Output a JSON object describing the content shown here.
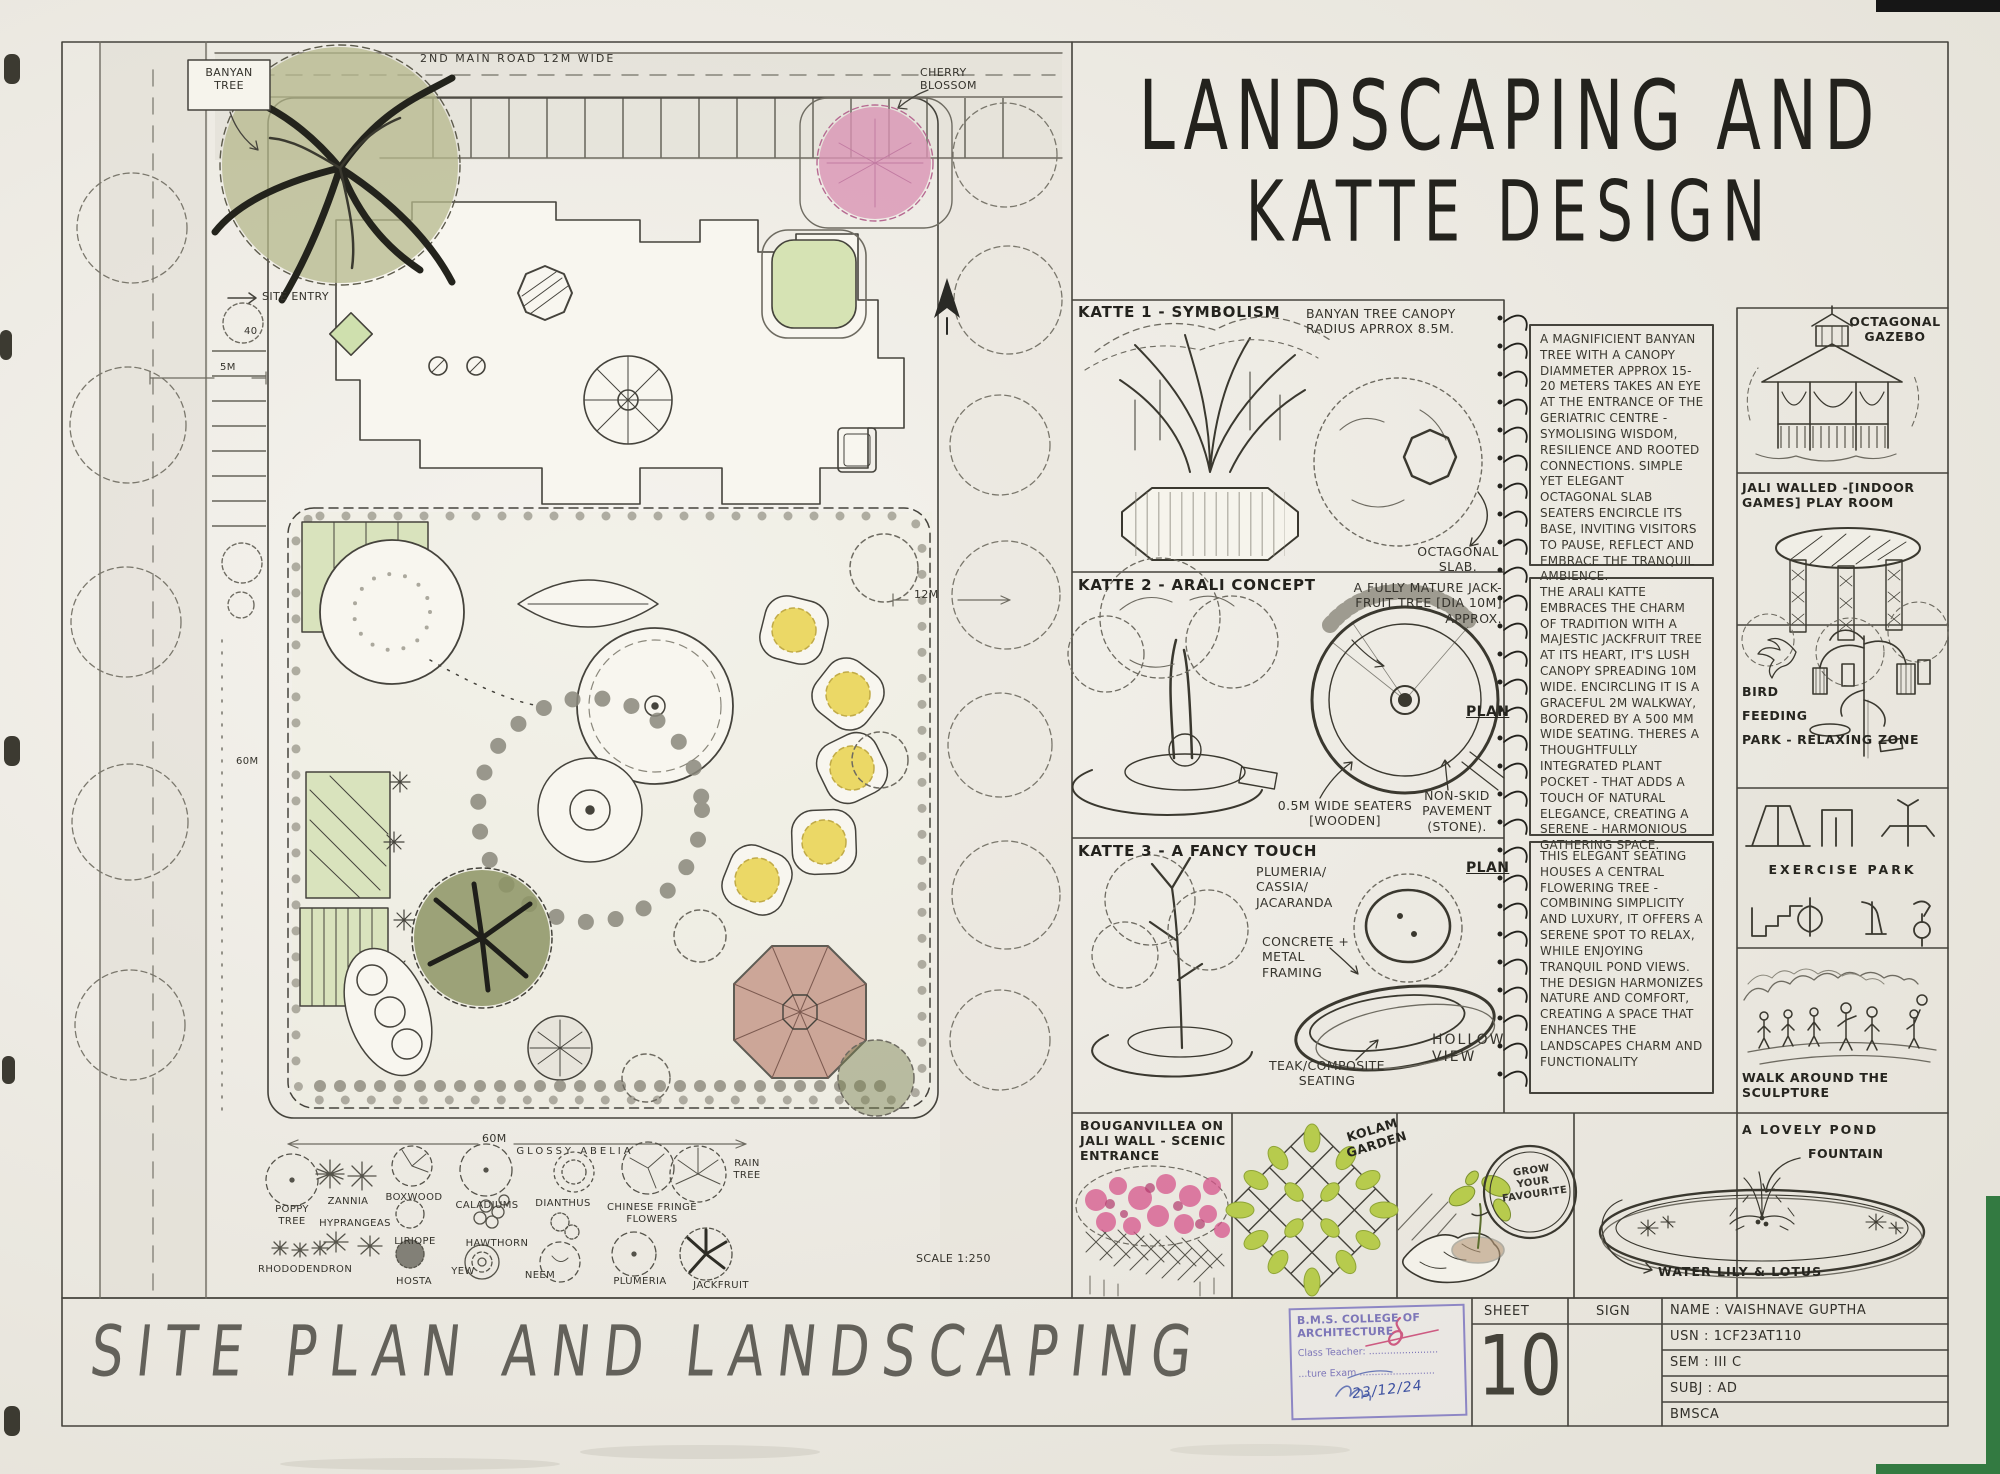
{
  "colors": {
    "paper": "#efece4",
    "ink": "#33312b",
    "pencil": "#6e6b61",
    "canopy_green": "#b5b88c",
    "lawn_green": "#d9e3bd",
    "flower_yellow": "#e9d34f",
    "cherry_pink": "#d993b4",
    "bougainvillea_pink": "#d6558b",
    "pavilion_terracotta": "#c79a8b",
    "kolam_green": "#b7cb4d",
    "stamp_purple": "#7d76b8",
    "signature_blue": "#3c50a0",
    "signature_red": "#c2285a",
    "scan_green": "#337a41"
  },
  "sheet": {
    "title_line1": "LANDSCAPING AND",
    "title_line2": "KATTE DESIGN",
    "bottom_title": "SITE PLAN AND LANDSCAPING",
    "scale": "SCALE 1:250"
  },
  "site_plan": {
    "banyan_tree": "BANYAN TREE",
    "main_road": "2ND MAIN ROAD 12M WIDE",
    "site_entry": "SITE ENTRY",
    "cherry_blossom": "CHERRY BLOSSOM",
    "dim_40": "40",
    "dim_5m": "5M",
    "dim_60m_left": "60M",
    "dim_12m": "12M",
    "dim_60m_bottom": "60M",
    "legend": [
      "POPPY TREE",
      "ZANNIA",
      "BOXWOOD",
      "CALADIUMS",
      "GLOSSY ABELIA",
      "DIANTHUS",
      "CHINESE FRINGE FLOWERS",
      "RAIN TREE",
      "HYPRANGEAS",
      "LIRIOPE",
      "HAWTHORN",
      "RHODODENDRON",
      "HOSTA",
      "YEW",
      "NEEM",
      "PLUMERIA",
      "JACKFRUIT"
    ]
  },
  "katte": [
    {
      "title": "KATTE 1 - SYMBOLISM",
      "canopy_note": "BANYAN TREE CANOPY RADIUS APRROX 8.5M.",
      "slab_note": "OCTAGONAL SLAB.",
      "note": "A MAGNIFICIENT BANYAN TREE WITH A CANOPY DIAMMETER APPROX 15-20 METERS TAKES AN EYE AT THE ENTRANCE OF THE GERIATRIC CENTRE - SYMOLISING WISDOM, RESILIENCE AND ROOTED CONNECTIONS. SIMPLE YET ELEGANT OCTAGONAL SLAB SEATERS ENCIRCLE ITS BASE, INVITING VISITORS TO PAUSE, REFLECT AND EMBRACE THE TRANQUIL AMBIENCE."
    },
    {
      "title": "KATTE 2 - ARALI CONCEPT",
      "tree_note": "A FULLY MATURE JACK-FRUIT TREE [DIA 10M] APPROX.",
      "plan_label": "PLAN",
      "seaters_note": "0.5M WIDE SEATERS [WOODEN]",
      "pavement_note": "NON-SKID PAVEMENT (STONE).",
      "note": "THE ARALI KATTE EMBRACES THE CHARM OF TRADITION WITH A MAJESTIC JACKFRUIT TREE AT ITS HEART, IT'S LUSH CANOPY SPREADING 10M WIDE. ENCIRCLING IT IS A GRACEFUL 2M WALKWAY, BORDERED BY A 500 MM WIDE SEATING. THERES A THOUGHTFULLY INTEGRATED PLANT POCKET - THAT ADDS A TOUCH OF NATURAL ELEGANCE, CREATING A SERENE - HARMONIOUS GATHERING SPACE."
    },
    {
      "title": "KATTE 3 - A FANCY TOUCH",
      "tree_note": "PLUMERIA/ CASSIA/ JACARANDA",
      "framing_note": "CONCRETE + METAL FRAMING",
      "plan_label": "PLAN",
      "seating_note": "TEAK/COMPOSITE SEATING",
      "view_note": "HOLLOW VIEW",
      "note": "THIS ELEGANT SEATING HOUSES A CENTRAL FLOWERING TREE - COMBINING SIMPLICITY AND LUXURY, IT OFFERS A SERENE SPOT TO RELAX, WHILE ENJOYING TRANQUIL POND VIEWS. THE DESIGN HARMONIZES NATURE AND COMFORT, CREATING A SPACE THAT ENHANCES THE LANDSCAPES CHARM AND FUNCTIONALITY"
    }
  ],
  "side_panels": {
    "gazebo": "OCTAGONAL GAZEBO",
    "playroom": "JALI WALLED -[INDOOR GAMES] PLAY ROOM",
    "bird_l1": "BIRD",
    "bird_l2": "FEEDING",
    "bird_l3": "PARK - RELAXING",
    "bird_l4": "ZONE",
    "exercise": "EXERCISE PARK",
    "walk": "WALK AROUND THE SCULPTURE",
    "pond_title": "A LOVELY POND",
    "pond_fountain": "FOUNTAIN",
    "pond_plants": "WATER LILY & LOTUS"
  },
  "bottom_panels": {
    "bouganvillea": "BOUGANVILLEA ON JALI WALL - SCENIC ENTRANCE",
    "kolam": "KOLAM GARDEN",
    "grow": "GROW YOUR FAVOURITE"
  },
  "title_block": {
    "sheet_label": "SHEET",
    "sheet_number": "10",
    "sign_label": "SIGN",
    "name": "NAME : VAISHNAVE GUPTHA",
    "usn": "USN : 1CF23AT110",
    "sem": "SEM : III C",
    "subj": "SUBJ : AD",
    "org": "BMSCA"
  },
  "stamp": {
    "college": "B.M.S. COLLEGE OF ARCHITECTURE",
    "line2": "Class Teacher: .......................",
    "line3": "...ture Exam .........................",
    "date": "23/12/24"
  }
}
